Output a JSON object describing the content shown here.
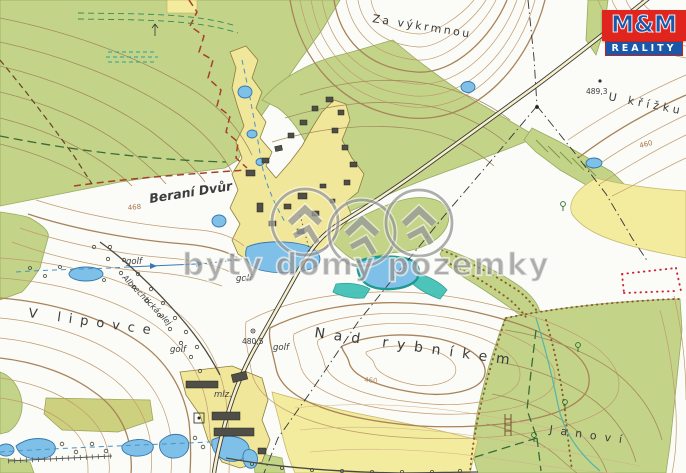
{
  "watermark": {
    "text": "byty domy pozemky"
  },
  "logo": {
    "line1": "M&M",
    "line2": "REALITY"
  },
  "colors": {
    "logo_red": "#e0251f",
    "logo_blue": "#1a57a8",
    "forest_green": "#c3d489",
    "field_yellow": "#f3eb9d",
    "village_yellow": "#f0e79b",
    "water_blue": "#7fc0e8",
    "wetland_teal": "#3fc0b4",
    "contour_brown": "#c09a6e",
    "boundary_red": "#a6402a",
    "watermark_gray": "#6e6e6e"
  },
  "place_labels": [
    {
      "name": "za-vykrmnou",
      "text": "Za výkrmnou"
    },
    {
      "name": "u-krizku",
      "text": "U křížku"
    },
    {
      "name": "berani-dvur",
      "text": "Beraní Dvůr"
    },
    {
      "name": "nad-rybnikem",
      "text": "Nad rybníkem"
    },
    {
      "name": "v-lipovce",
      "text": "V lipovce"
    },
    {
      "name": "janovi",
      "text": "Janoví"
    },
    {
      "name": "albrechticka-alej",
      "text": "Albrechtická alej"
    },
    {
      "name": "mlz",
      "text": "mlz."
    }
  ],
  "golf_labels": [
    "golf",
    "golf",
    "golf",
    "golf"
  ],
  "spot_elevations": [
    "489,3",
    "480,5"
  ],
  "contour_labels": [
    "468",
    "460",
    "460"
  ]
}
